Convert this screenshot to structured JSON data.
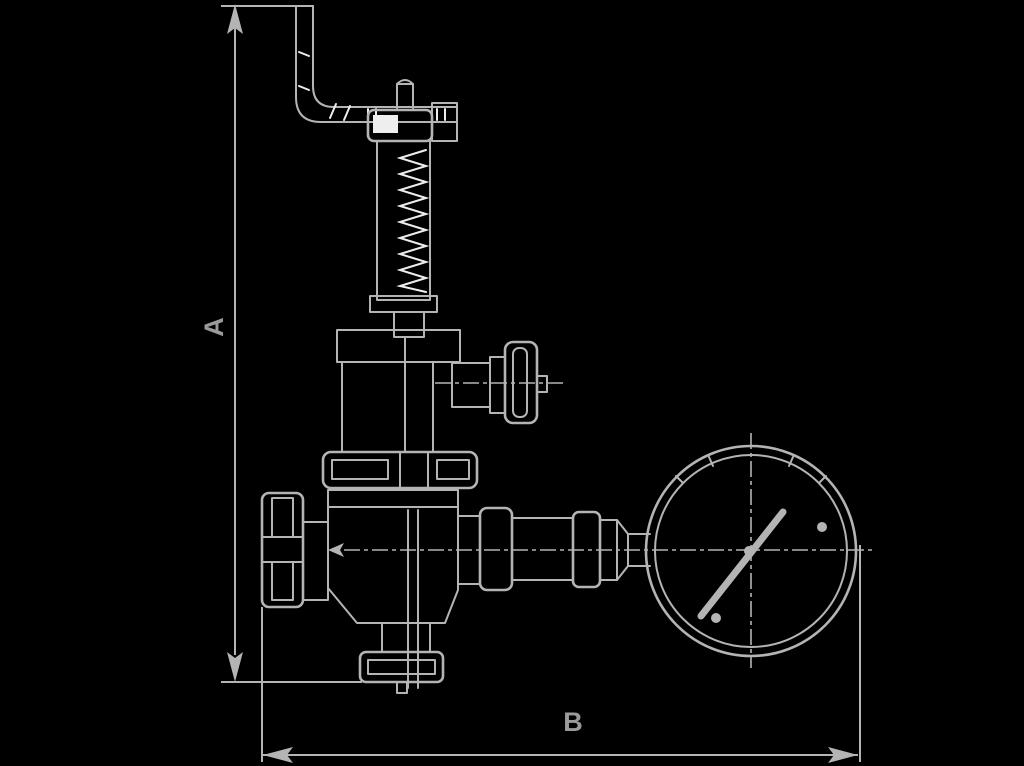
{
  "figure": {
    "labels": {
      "dimension_a": "A",
      "dimension_b": "B"
    },
    "colors": {
      "background": "#000000",
      "line": "#b4b4b4",
      "bright_detail": "#eeeeee",
      "label_text": "#9a9a9a"
    },
    "parts": [
      "test-lever",
      "adjusting-cap",
      "spring-housing",
      "bonnet",
      "spring-flange",
      "valve-body",
      "handwheel",
      "side-port-knob",
      "gauge-connection-pipe",
      "pressure-gauge",
      "outlet-flange"
    ]
  }
}
